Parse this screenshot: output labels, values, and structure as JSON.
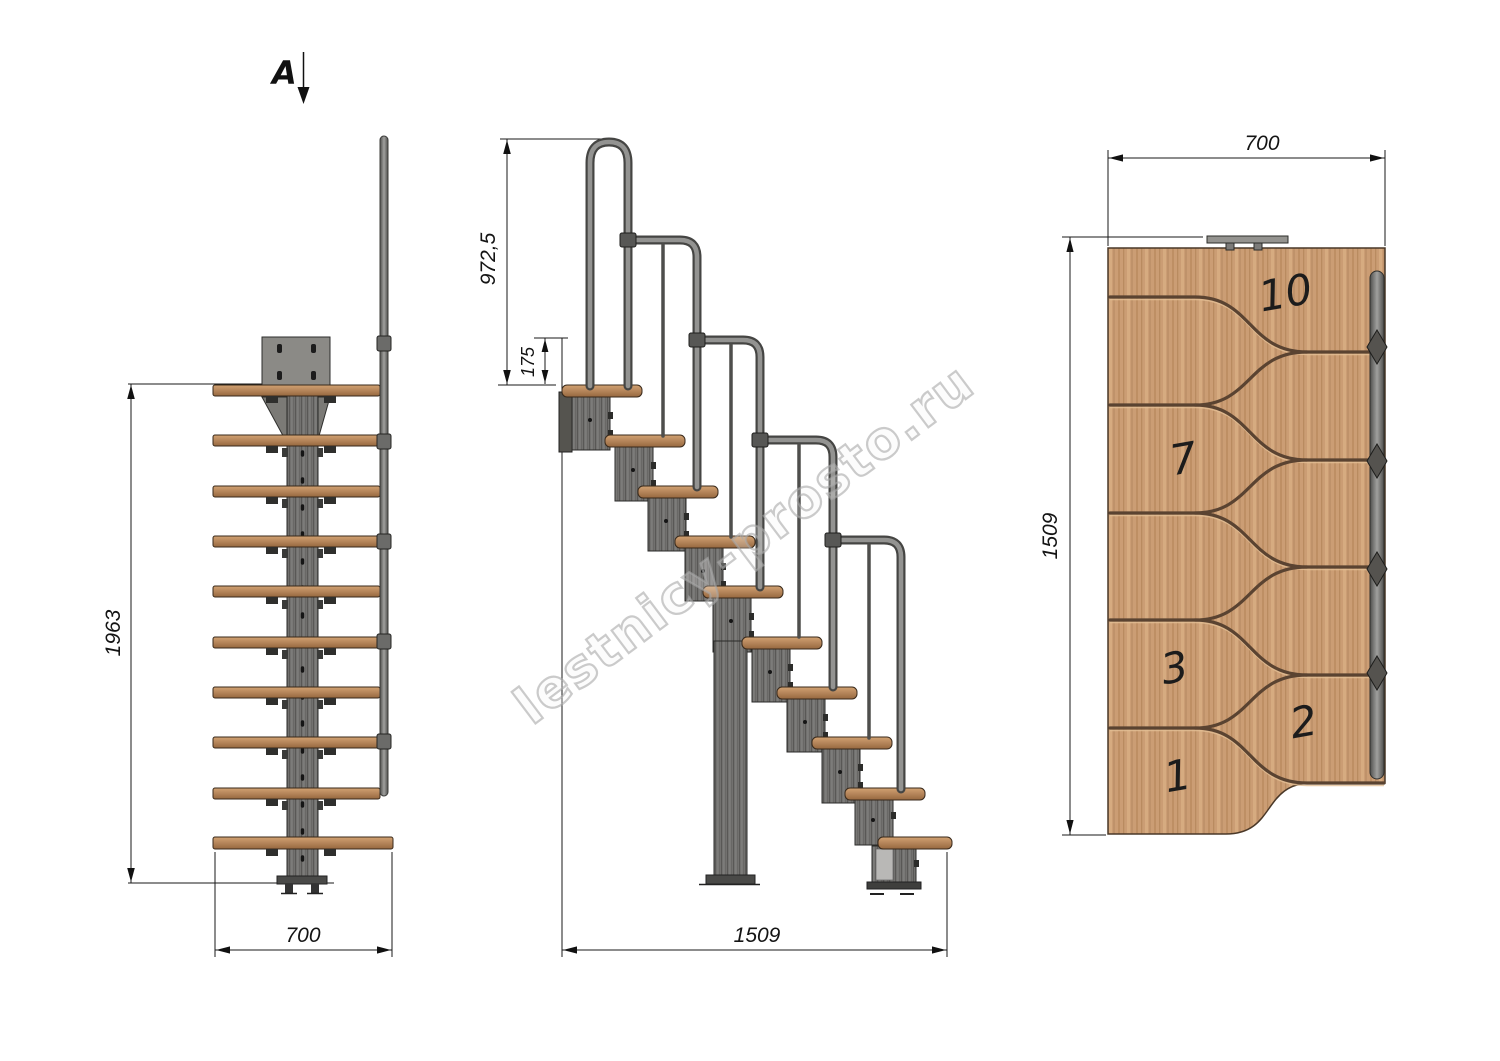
{
  "section_marker": {
    "label": "A"
  },
  "watermark": {
    "text": "lestnicy-prosto.ru"
  },
  "front_view": {
    "dim_height": "1963",
    "dim_width": "700"
  },
  "side_view": {
    "dim_handrail_height": "972,5",
    "dim_top_rise": "175",
    "dim_length": "1509"
  },
  "plan_view": {
    "dim_width": "700",
    "dim_length": "1509",
    "step_labels": [
      "10",
      "7",
      "3",
      "2",
      "1"
    ]
  },
  "colors": {
    "background": "#ffffff",
    "wood_tread": "#b5855a",
    "wood_plan": "#cb9d74",
    "divider_brown": "#5a4331",
    "metal_module": "#72716f",
    "rail_gray": "#8e8e8c",
    "dim_ink": "#141414",
    "watermark_gray": "#a9a9a9"
  }
}
